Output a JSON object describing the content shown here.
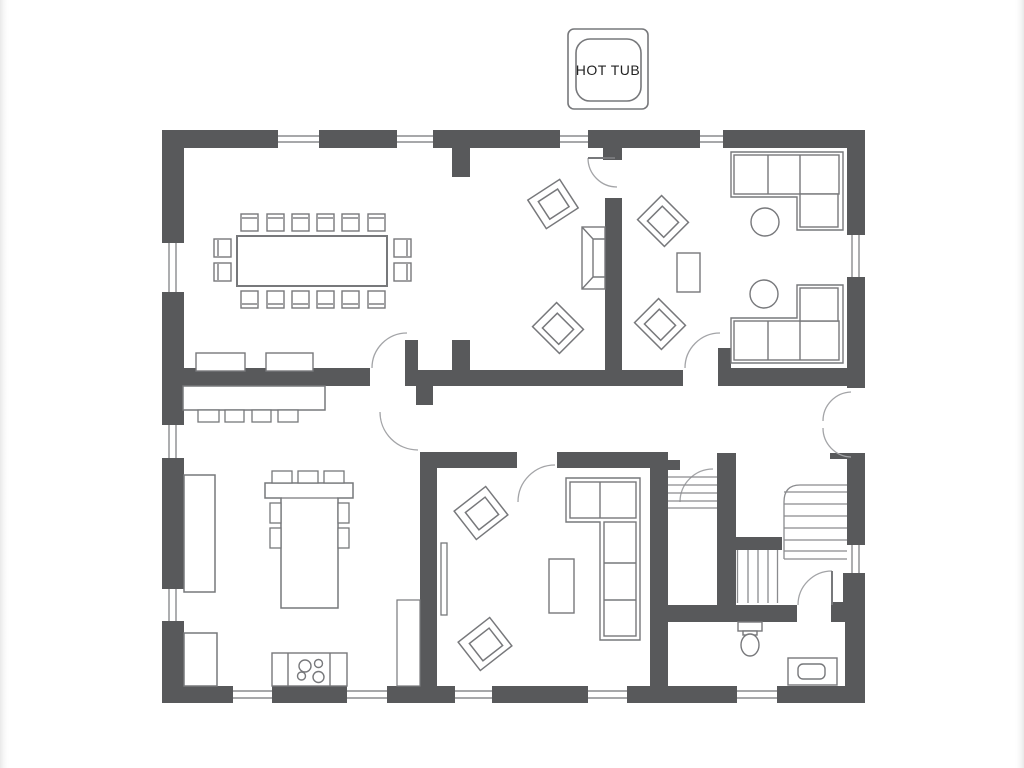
{
  "hot_tub": {
    "label": "HOT TUB"
  },
  "palette": {
    "wall": "#58595b",
    "furniture_line": "#77787b",
    "fine_line": "#8a8b8e",
    "door_arc": "#a3a4a7",
    "text": "#232323",
    "background": "#ffffff"
  },
  "inventory": {
    "dining_tables": 1,
    "dining_chairs": 16,
    "sideboards": 2,
    "breakfast_bar_stools": 4,
    "island_stools": 7,
    "stove_burners": 4,
    "lounge_armchairs": 4,
    "fireplaces": 1,
    "hall_side_tables": 1,
    "sectional_sofas": 3,
    "round_side_tables": 2,
    "family_armchairs": 2,
    "coffee_tables": 1,
    "tv_units": 1,
    "kitchen_counters": 3,
    "toilets": 1,
    "sinks": 1,
    "stair_flights": 3,
    "windows": 14,
    "door_swings": 8,
    "double_doors": 1
  }
}
